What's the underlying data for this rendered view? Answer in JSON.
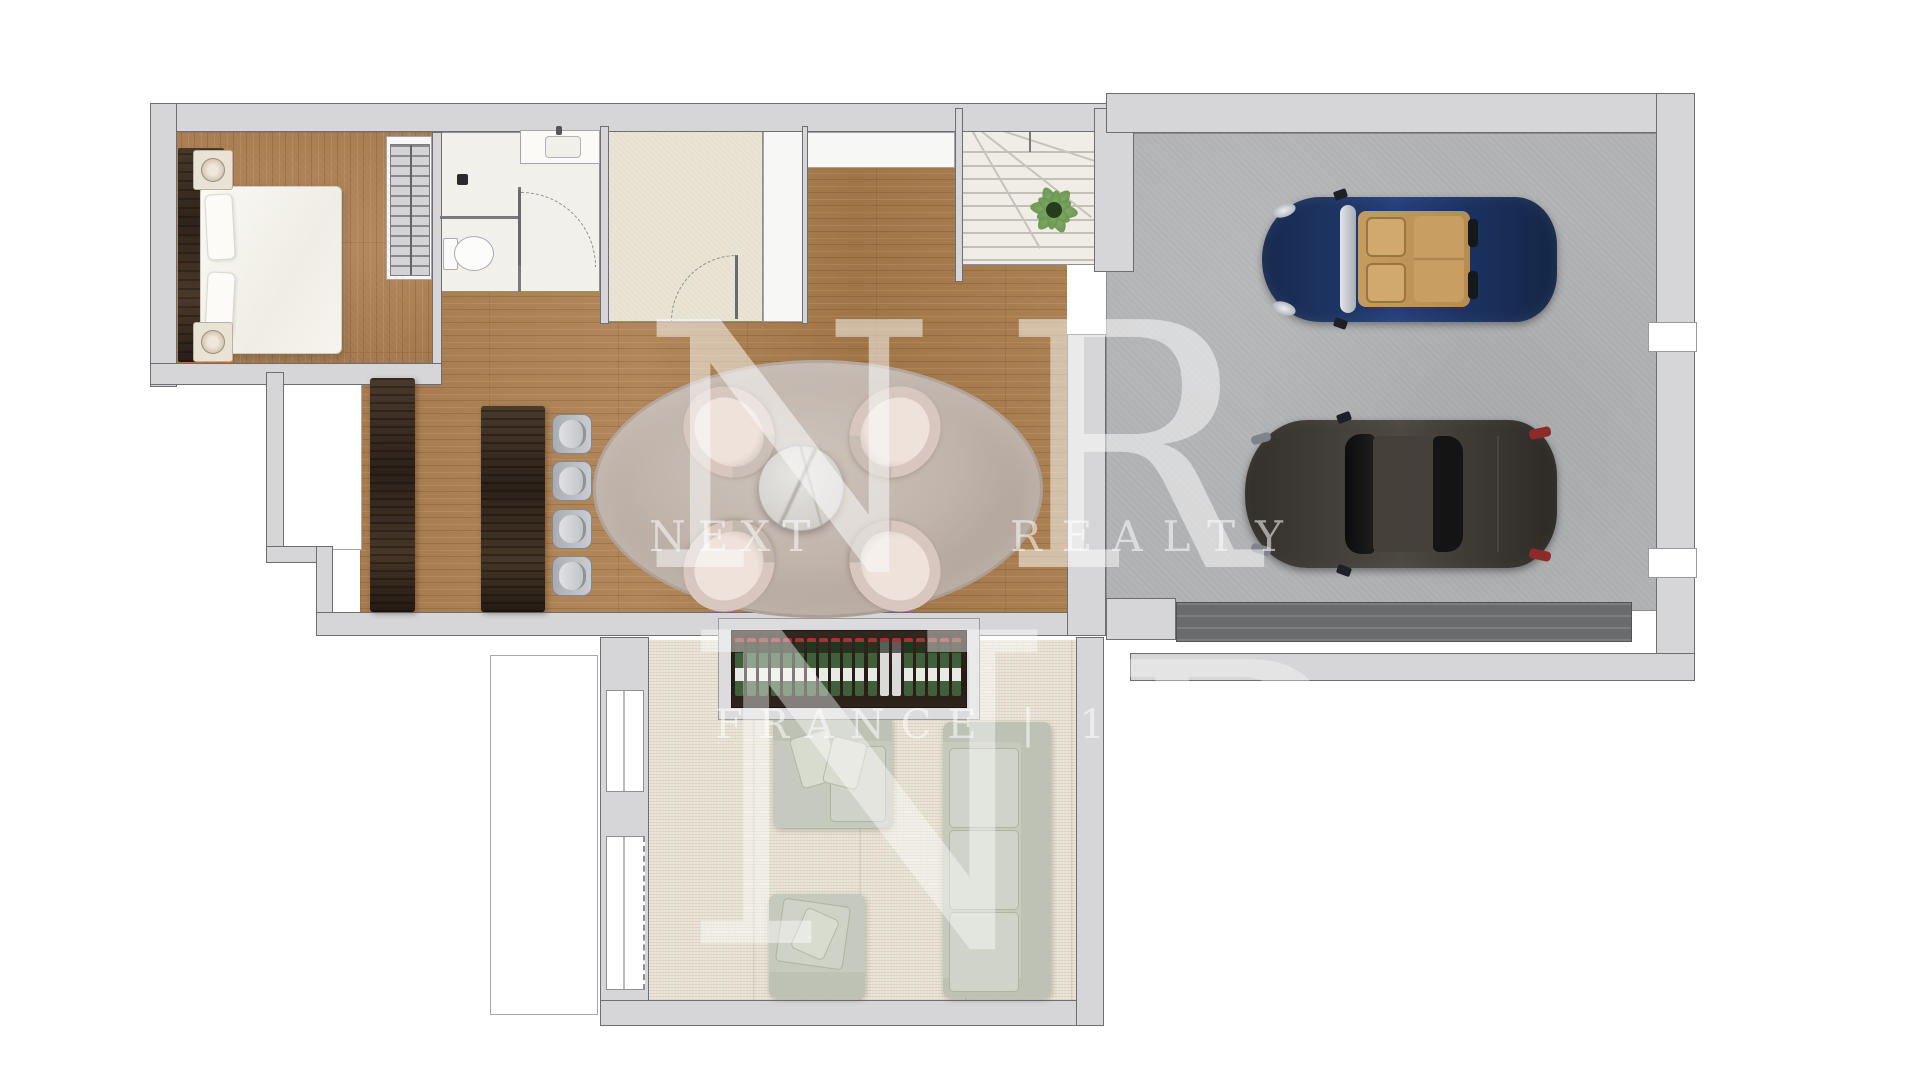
{
  "watermark": {
    "monogram_top_left_letter": "N",
    "monogram_top_right_letter": "R",
    "brand_line_left": "NEXT",
    "brand_line_right": "REALTY",
    "monogram_bottom_left_letter": "N",
    "monogram_bottom_right_letter": "R",
    "tagline": "FRANCE | 1994"
  },
  "plan": {
    "type": "residential-floor-plan-top-view",
    "rooms": [
      "bedroom",
      "wardrobe",
      "bathroom",
      "dressing-room",
      "hallway",
      "staircase",
      "kitchen-dining",
      "garage",
      "living-room",
      "terrace"
    ],
    "furniture": {
      "bedroom": [
        "double-bed",
        "two-pillows",
        "two-nightstands-with-lamps",
        "area-rug",
        "headboard-panel"
      ],
      "bathroom": [
        "toilet",
        "sink-counter",
        "floor-drain",
        "door-swing"
      ],
      "kitchen": [
        "island-counter",
        "sideboard"
      ],
      "dining": [
        "oval-rug",
        "round-marble-table",
        "four-tub-chairs"
      ],
      "living_room": [
        "wine-rack",
        "loveseat-with-pillows",
        "armchair",
        "three-seat-sofa"
      ],
      "staircase": [
        "treads",
        "winder-steps",
        "potted-plant"
      ]
    },
    "cars": [
      {
        "type": "convertible-roadster",
        "body_color": "#1d3363",
        "interior_color": "#c59b60",
        "facing": "left"
      },
      {
        "type": "sports-coupe",
        "body_color": "#3e3a34",
        "taillight_color": "#8d2a2a",
        "facing": "left"
      }
    ],
    "repeats": {
      "bar_stools": {
        "count": 4
      },
      "dining_chairs": {
        "count": 4
      },
      "wine_bottles": {
        "count": 19,
        "light_indices": [
          12,
          13
        ]
      },
      "stair_treads": {
        "count": 9
      },
      "sofa_seat_cushions": {
        "count": 3
      },
      "plant_leaves": {
        "count": 6
      }
    },
    "colors": {
      "wall_fill": "#d6d6d8",
      "wall_outline": "#6e6e72",
      "wood_floor": "#a87d51",
      "carpet": "#e8e2d4",
      "concrete": "#b3b4b6",
      "dressing_floor": "#eae4d5",
      "dining_rug": "#c0b4ab",
      "sofa": "#c6cabe",
      "walnut_furniture": "#3a2d22",
      "plant": "#5c8746",
      "wine_bottle_green": "#40603a",
      "wine_cap_red": "#a83232",
      "watermark": "rgba(255,255,255,0.5)"
    }
  }
}
